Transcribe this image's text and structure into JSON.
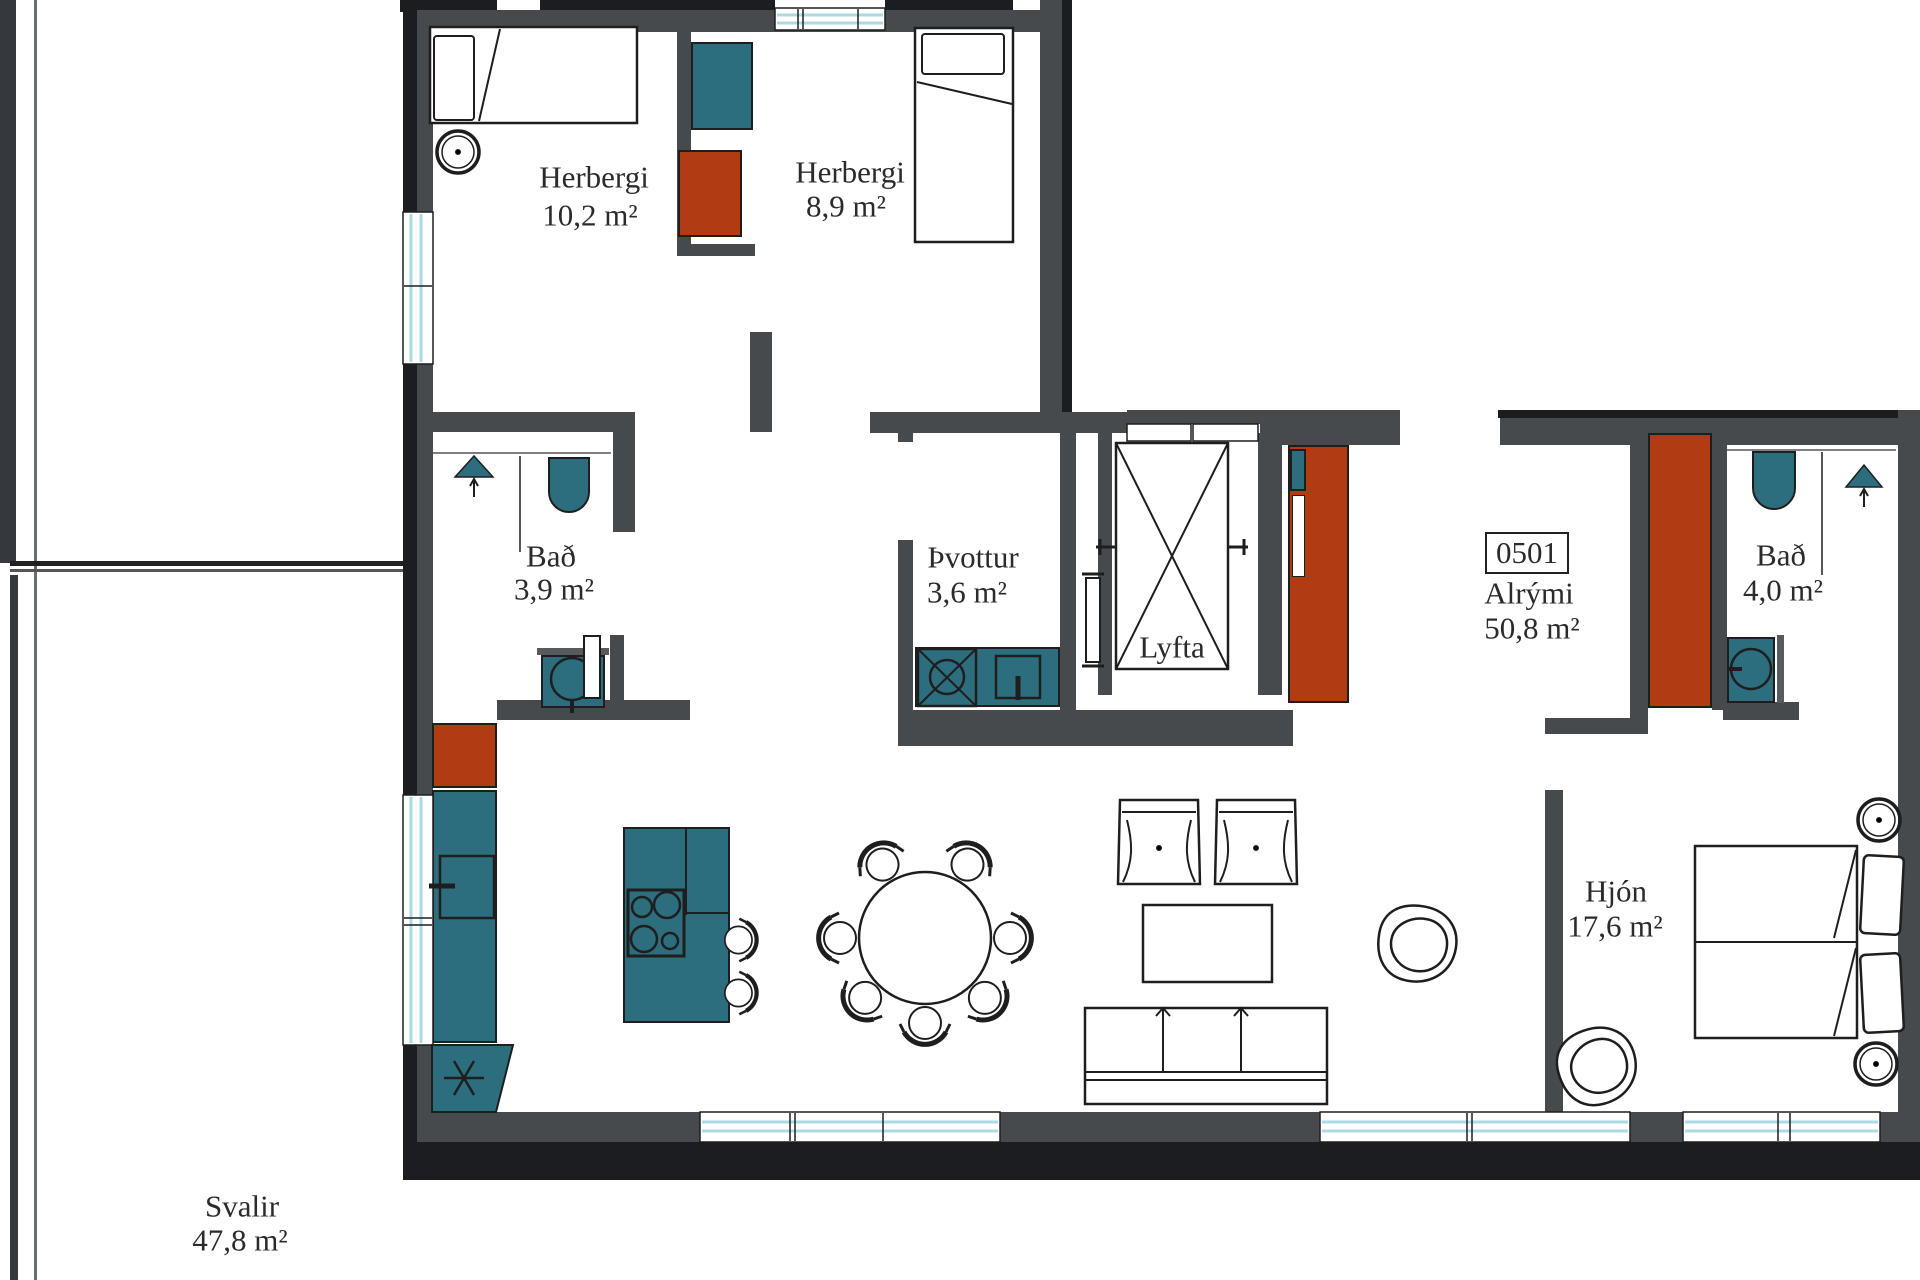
{
  "unit": {
    "number": "0501"
  },
  "rooms": [
    {
      "key": "herbergi1",
      "name": "Herbergi",
      "area": "10,2 m²"
    },
    {
      "key": "herbergi2",
      "name": "Herbergi",
      "area": "8,9 m²"
    },
    {
      "key": "bad1",
      "name": "Bað",
      "area": "3,9 m²"
    },
    {
      "key": "thvottur",
      "name": "Þvottur",
      "area": "3,6 m²"
    },
    {
      "key": "lyfta",
      "name": "Lyfta",
      "area": ""
    },
    {
      "key": "alrymi",
      "name": "Alrými",
      "area": "50,8 m²"
    },
    {
      "key": "bad2",
      "name": "Bað",
      "area": "4,0 m²"
    },
    {
      "key": "hjon",
      "name": "Hjón",
      "area": "17,6 m²"
    },
    {
      "key": "svalir",
      "name": "Svalir",
      "area": "47,8 m²"
    }
  ],
  "colors": {
    "wall": "#474a4d",
    "wall-dark": "#1b1d20",
    "cabinet-teal": "#2d6e7e",
    "cabinet-red": "#b23c12",
    "glass": "#aadbe2",
    "line": "#1e1e1e",
    "text": "#2b2b2b"
  }
}
